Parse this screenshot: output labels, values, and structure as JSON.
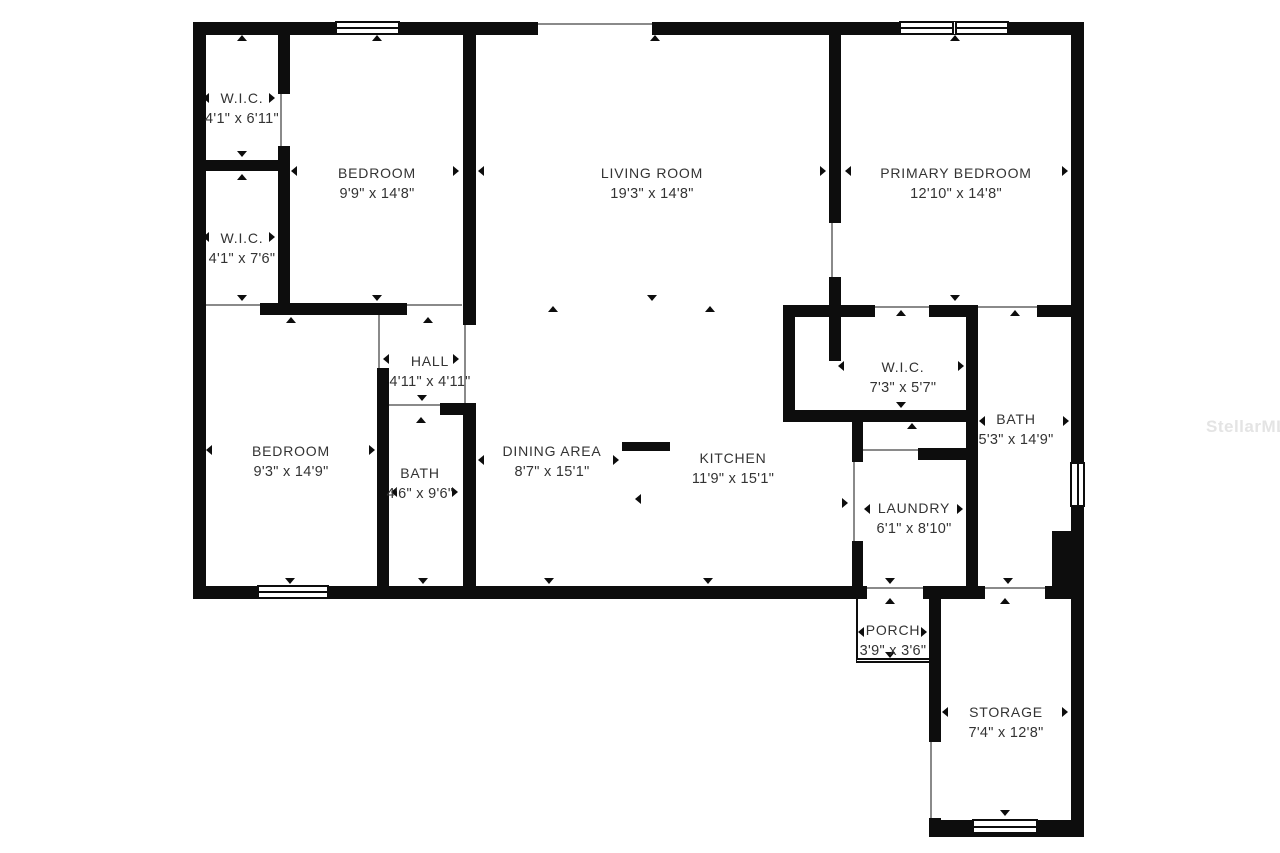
{
  "floor_plan": {
    "watermark": "StellarMLS",
    "rooms": [
      {
        "id": "wic-1",
        "name": "W.I.C.",
        "dims": "4'1\" x 6'11\""
      },
      {
        "id": "wic-2",
        "name": "W.I.C.",
        "dims": "4'1\" x 7'6\""
      },
      {
        "id": "bedroom-2",
        "name": "BEDROOM",
        "dims": "9'9\" x 14'8\""
      },
      {
        "id": "living-room",
        "name": "LIVING ROOM",
        "dims": "19'3\" x 14'8\""
      },
      {
        "id": "primary-bedroom",
        "name": "PRIMARY BEDROOM",
        "dims": "12'10\" x 14'8\""
      },
      {
        "id": "hall",
        "name": "HALL",
        "dims": "4'11\" x 4'11\""
      },
      {
        "id": "bedroom-3",
        "name": "BEDROOM",
        "dims": "9'3\" x 14'9\""
      },
      {
        "id": "bath-1",
        "name": "BATH",
        "dims": "4'6\" x 9'6\""
      },
      {
        "id": "dining-area",
        "name": "DINING AREA",
        "dims": "8'7\" x 15'1\""
      },
      {
        "id": "kitchen",
        "name": "KITCHEN",
        "dims": "11'9\" x 15'1\""
      },
      {
        "id": "wic-primary",
        "name": "W.I.C.",
        "dims": "7'3\" x 5'7\""
      },
      {
        "id": "bath-primary",
        "name": "BATH",
        "dims": "5'3\" x 14'9\""
      },
      {
        "id": "laundry",
        "name": "LAUNDRY",
        "dims": "6'1\" x 8'10\""
      },
      {
        "id": "porch",
        "name": "PORCH",
        "dims": "3'9\" x 3'6\""
      },
      {
        "id": "storage",
        "name": "STORAGE",
        "dims": "7'4\" x 12'8\""
      }
    ],
    "colors": {
      "wall": "#0d0d0d",
      "opening_line": "#8a8a8a",
      "label_text": "#333333",
      "watermark_text": "#e4e4e4"
    }
  }
}
